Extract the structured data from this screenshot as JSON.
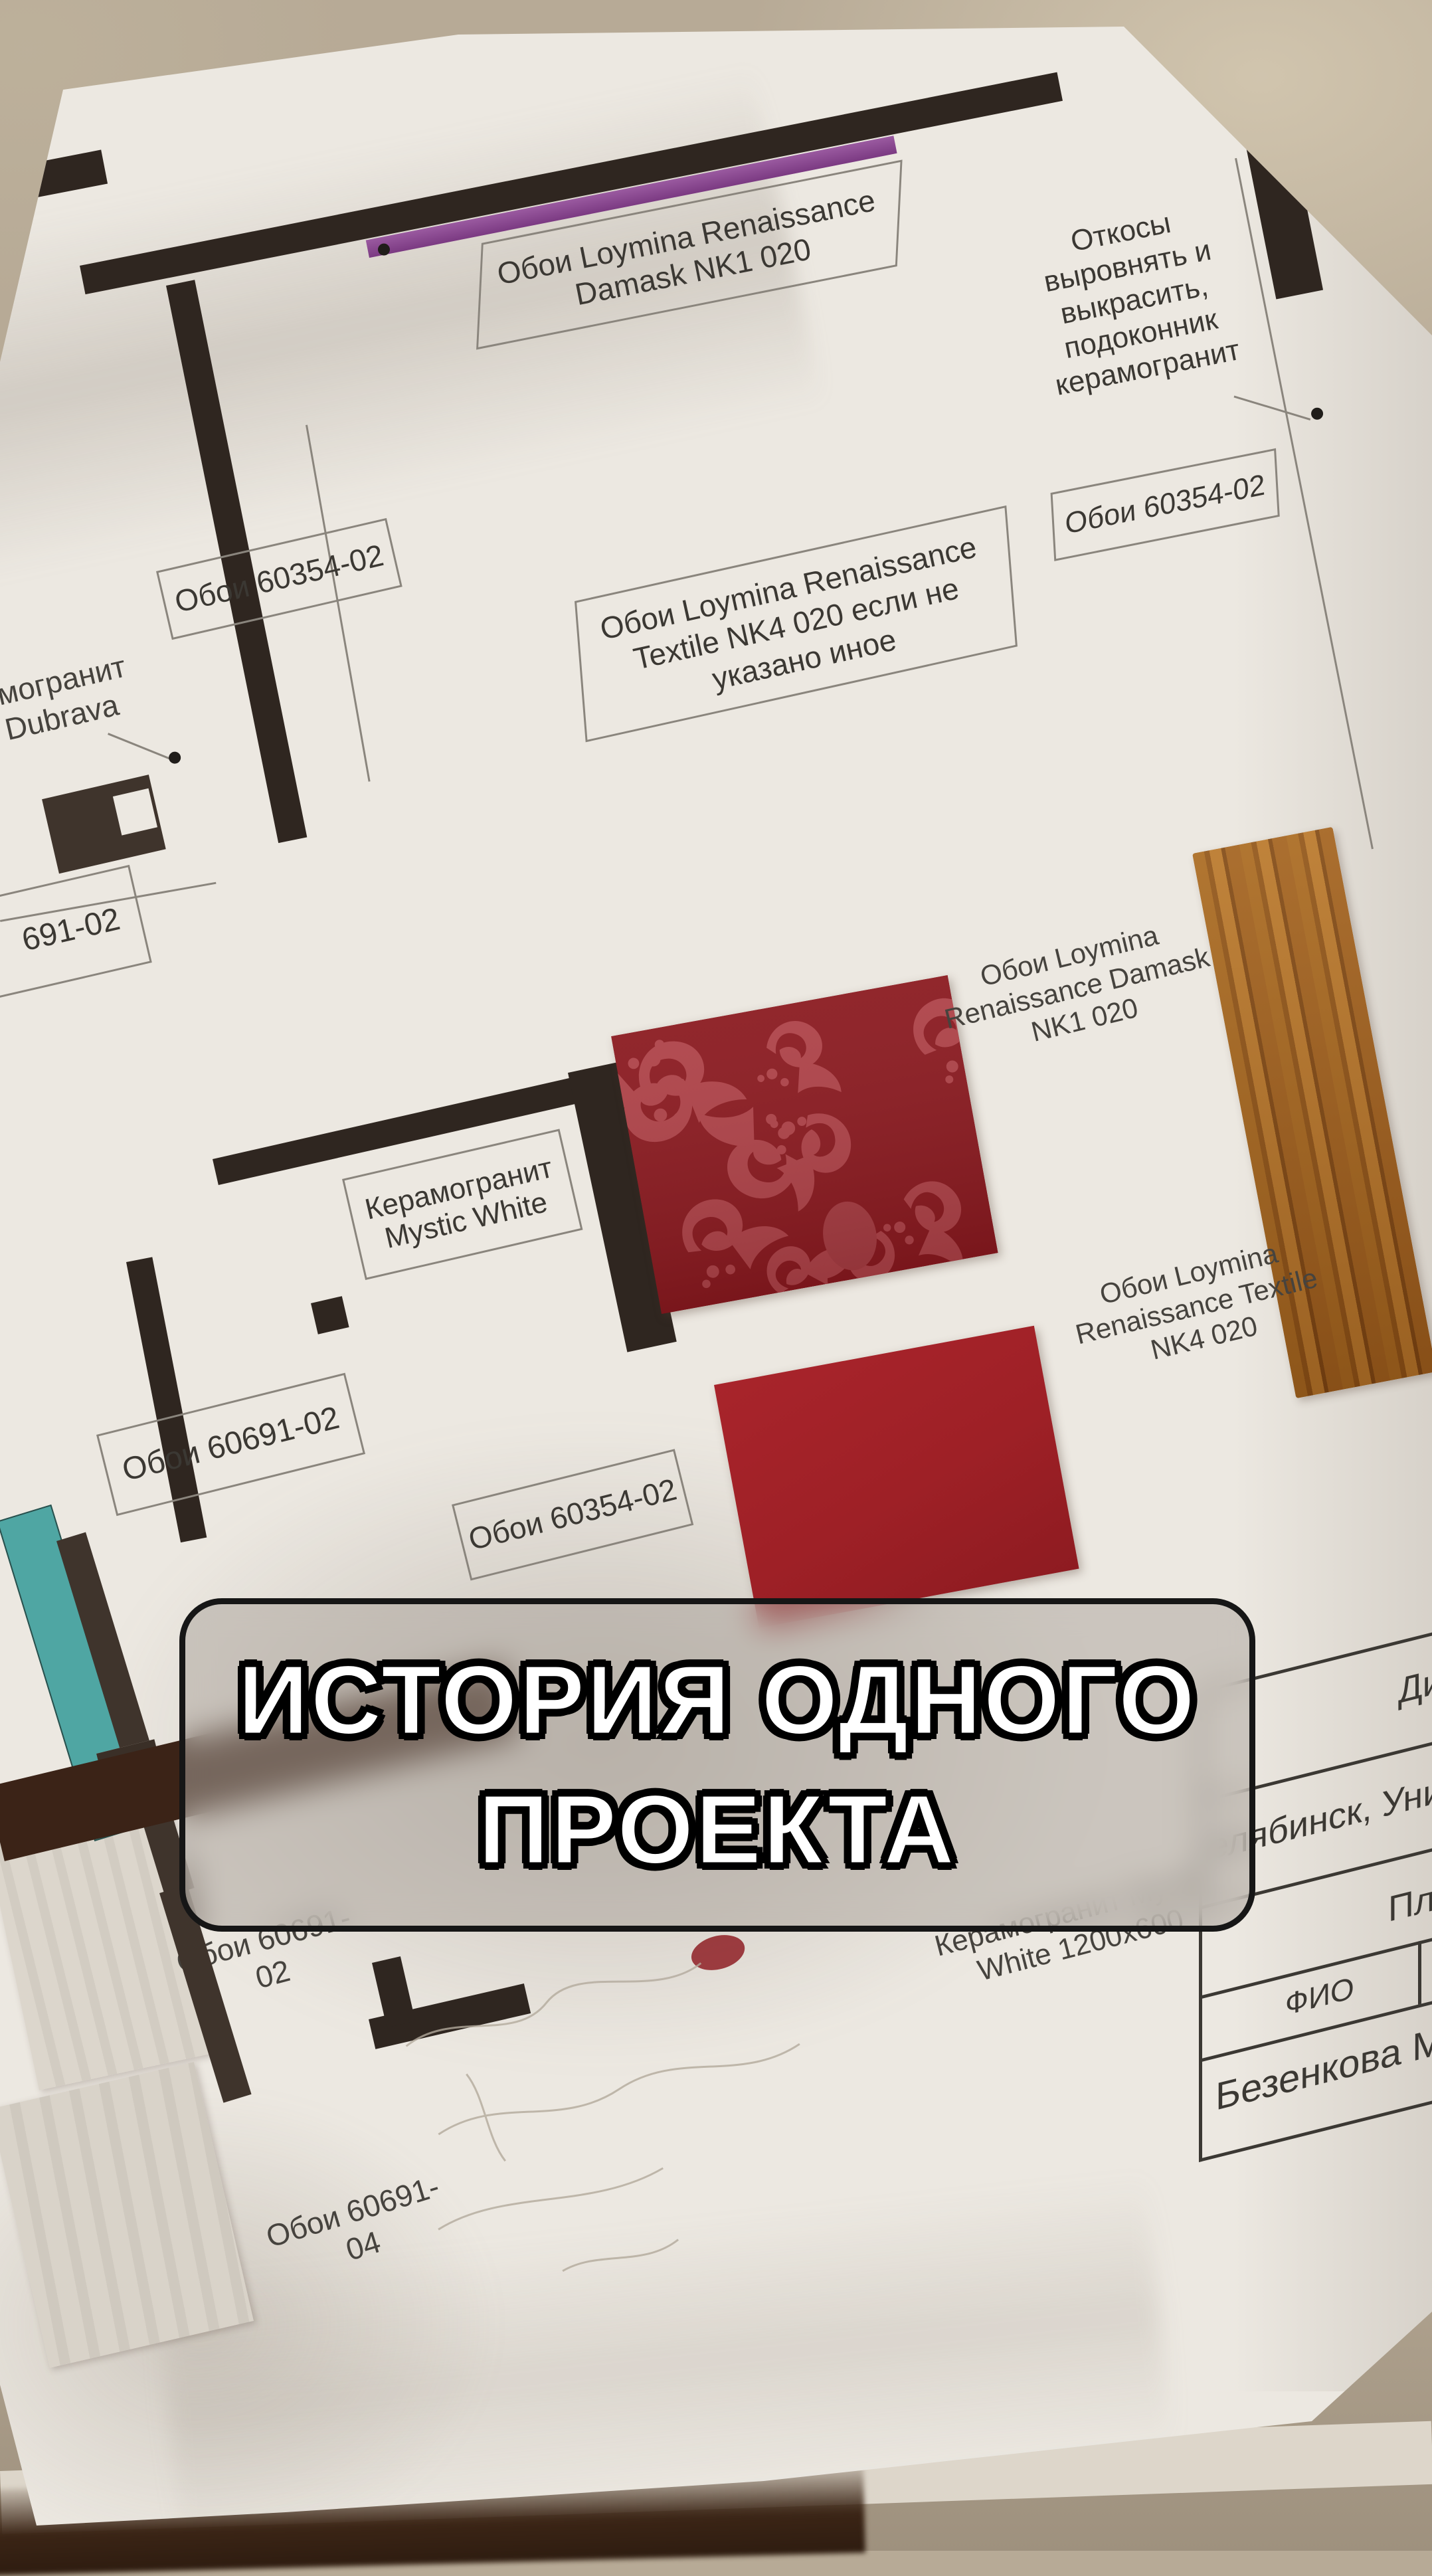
{
  "caption_overlay": {
    "line1": "ИСТОРИЯ ОДНОГО",
    "line2": "ПРОЕКТА"
  },
  "floor_plan": {
    "accent_wall_label": "Обои Loymina Renaissance\nDamask NK1 020",
    "window_note": "Откосы\nвыровнять и\nвыкрасить,\nподоконник\nкерамогранит",
    "niche_label": "Обои 60354-02",
    "room_label_1": "Обои 60354-02",
    "dubrava_label": "могранит\nDubrava",
    "main_room_label": "Обои Loymina Renaissance\nTextile NK4 020 если не\nуказано иное",
    "partial_label": "691-02",
    "tile_label": "Керамогранит\nMystic White",
    "room_label_2": "Обои 60691-02",
    "room_label_3": "Обои 60354-02"
  },
  "samples": {
    "damask": {
      "caption": "Обои Loymina\nRenaissance Damask\nNK1 020",
      "base_color": "#8a191f",
      "pattern_color": "#ae4147"
    },
    "textile": {
      "caption": "Обои Loymina\nRenaissance Textile\nNK4 020",
      "color": "#9e2026"
    },
    "wood": {
      "color": "#a2611f"
    },
    "grey1": {
      "caption": "Обои 60691-02",
      "color": "#d9d3c9"
    },
    "tile": {
      "caption": "Керамогранит Mystic\nWhite 1200x600"
    },
    "grey2": {
      "caption": "Обои 60691-04",
      "color": "#d6d0c6"
    }
  },
  "title_block": {
    "row1": "Диз",
    "row2": "елябинск, Унив",
    "row3": "Пла",
    "fio_header": "ФИО",
    "fio_value": "Безенкова М.Е"
  },
  "colors": {
    "table": "#b7aa96",
    "paper": "#ece8e1",
    "wall_dark": "#2f2620",
    "drawing_line": "#8a857d",
    "ink": "#3b3833",
    "accent_purple": "#84428d",
    "teal": "#4fa6a3",
    "overlay_border": "#161616",
    "caption_text": "#ffffff"
  }
}
